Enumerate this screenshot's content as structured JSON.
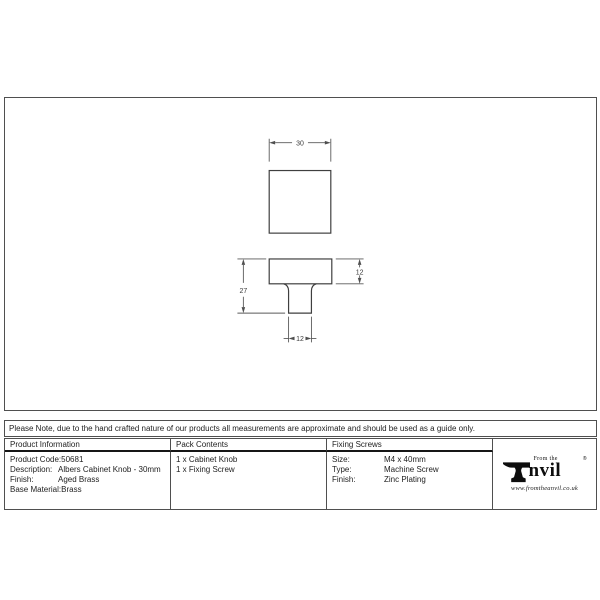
{
  "drawing": {
    "top_view": {
      "width_label": "30"
    },
    "front_view": {
      "overall_height_label": "27",
      "head_height_label": "12",
      "stem_width_label": "12"
    }
  },
  "note": "Please Note, due to the hand crafted nature of our products all measurements are approximate and should be used as a guide only.",
  "table": {
    "product_information": {
      "header": "Product Information",
      "rows": [
        {
          "label": "Product Code:",
          "value": "50681"
        },
        {
          "label": "Description:",
          "value": "Albers Cabinet Knob - 30mm"
        },
        {
          "label": "Finish:",
          "value": "Aged Brass"
        },
        {
          "label": "Base Material:",
          "value": "Brass"
        }
      ]
    },
    "pack_contents": {
      "header": "Pack Contents",
      "items": [
        "1 x Cabinet Knob",
        "1 x Fixing Screw"
      ]
    },
    "fixing_screws": {
      "header": "Fixing Screws",
      "rows": [
        {
          "label": "Size:",
          "value": "M4 x 40mm"
        },
        {
          "label": "Type:",
          "value": "Machine Screw"
        },
        {
          "label": "Finish:",
          "value": "Zinc Plating"
        }
      ]
    }
  },
  "logo": {
    "from_the": "From the",
    "brand": "nvil",
    "registered": "®",
    "website": "www.fromtheanvil.co.uk"
  },
  "colors": {
    "line": "#3f3f3f",
    "dim_line": "#5a5a5a",
    "border": "#4f4f4f",
    "header_rule": "#161616",
    "text": "#1e1e1e"
  }
}
